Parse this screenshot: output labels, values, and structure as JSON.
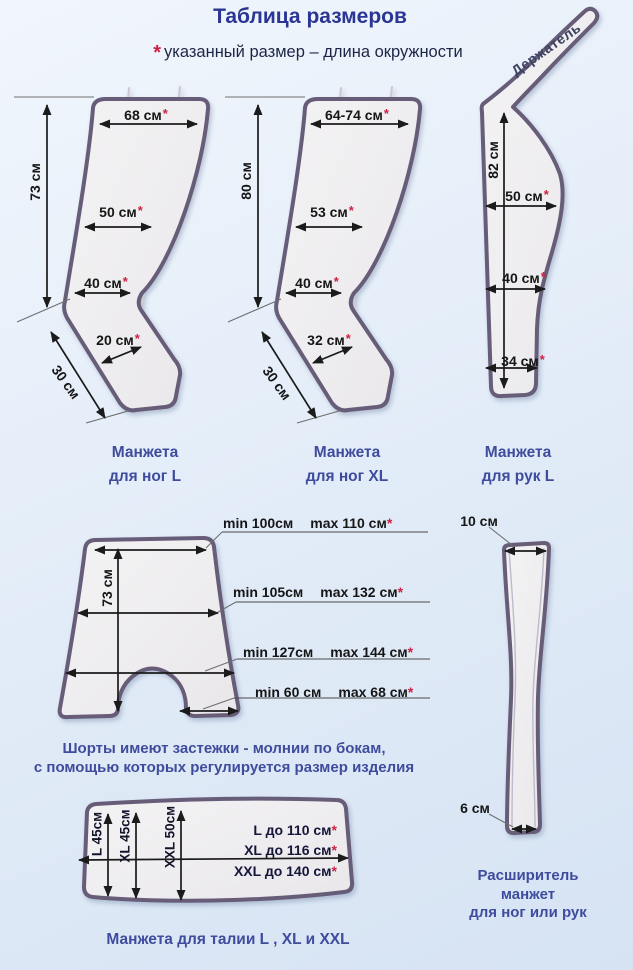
{
  "star": "*",
  "page": {
    "title": "Таблица размеров",
    "note": "указанный размер – длина окружности"
  },
  "figures": {
    "leg_l": {
      "height": "73 см",
      "top": "68 см",
      "mid": "50 см",
      "low": "40 см",
      "ankle": "20 см",
      "foot": "30 см",
      "caption1": "Манжета",
      "caption2": "для ног L"
    },
    "leg_xl": {
      "height": "80 см",
      "top": "64-74 см",
      "mid": "53 см",
      "low": "40 см",
      "ankle": "32 см",
      "foot": "30 см",
      "caption1": "Манжета",
      "caption2": "для ног XL"
    },
    "arm_l": {
      "strap": "Держатель",
      "height": "82 см",
      "top": "50 см",
      "mid": "40 см",
      "low": "34 см",
      "caption1": "Манжета",
      "caption2": "для рук L"
    },
    "shorts": {
      "height": "73 см",
      "rows": [
        {
          "min": "min 100см",
          "max": "max 110 см"
        },
        {
          "min": "min 105см",
          "max": "max 132 см"
        },
        {
          "min": "min 127см",
          "max": "max 144 см"
        },
        {
          "min": "min 60 см",
          "max": "max 68 см"
        }
      ],
      "caption1": "Шорты имеют застежки - молнии по бокам,",
      "caption2": "с помощью которых регулируется размер изделия"
    },
    "extender": {
      "top": "10 см",
      "bottom": "6 см",
      "caption1": "Расширитель",
      "caption2": "манжет",
      "caption3": "для ног или рук"
    },
    "waist": {
      "columns": [
        "L 45см",
        "XL 45см",
        "XXL 50см"
      ],
      "rows": [
        "L до 110 см",
        "XL до 116 см",
        "XXL до 140 см"
      ],
      "caption": "Манжета для талии  L , XL и XXL"
    }
  },
  "colors": {
    "title_blue": "#2b3694",
    "caption_blue": "#3f4c9d",
    "outline_purple": "#675d78",
    "star_red": "#cb2244",
    "background_top": "#f1f6fc",
    "background_bottom": "#d6e3f3"
  }
}
